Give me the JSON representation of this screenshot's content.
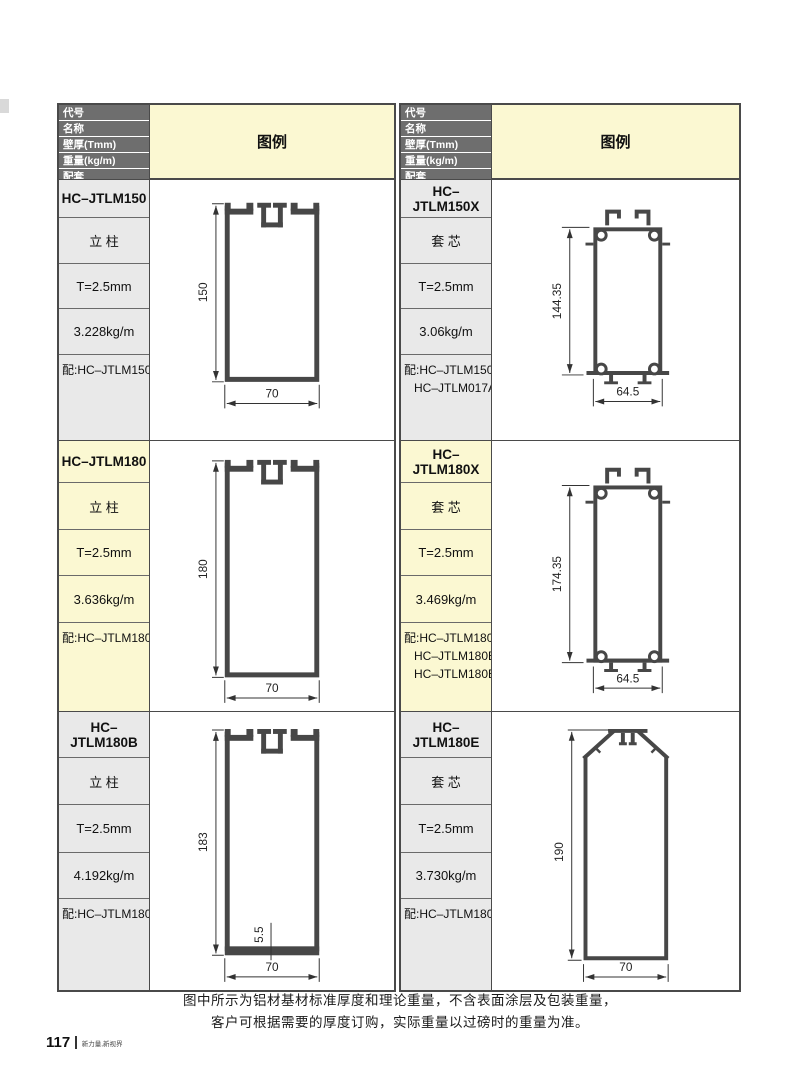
{
  "table_header": {
    "rows": [
      "代号",
      "名称",
      "壁厚(Tmm)",
      "重量(kg/m)",
      "配套"
    ],
    "legend": "图例"
  },
  "profiles": [
    {
      "code": "HC–JTLM150",
      "name": "立 柱",
      "thickness": "T=2.5mm",
      "weight": "3.228kg/m",
      "match_text": "配:HC–JTLM150X",
      "height_dim": "150",
      "width_dim": "70"
    },
    {
      "code": "HC–JTLM150X",
      "name": "套 芯",
      "thickness": "T=2.5mm",
      "weight": "3.06kg/m",
      "match_text": "配:HC–JTLM150\n   HC–JTLM017A",
      "height_dim": "144.35",
      "width_dim": "64.5"
    },
    {
      "code": "HC–JTLM180",
      "name": "立 柱",
      "thickness": "T=2.5mm",
      "weight": "3.636kg/m",
      "match_text": "配:HC–JTLM180X",
      "height_dim": "180",
      "width_dim": "70"
    },
    {
      "code": "HC–JTLM180X",
      "name": "套 芯",
      "thickness": "T=2.5mm",
      "weight": "3.469kg/m",
      "match_text": "配:HC–JTLM180\n   HC–JTLM180B\n   HC–JTLM180E",
      "height_dim": "174.35",
      "width_dim": "64.5"
    },
    {
      "code": "HC–JTLM180B",
      "name": "立 柱",
      "thickness": "T=2.5mm",
      "weight": "4.192kg/m",
      "match_text": "配:HC–JTLM180X",
      "height_dim": "183",
      "width_dim": "70",
      "bottom_bar_dim": "5.5"
    },
    {
      "code": "HC–JTLM180E",
      "name": "套 芯",
      "thickness": "T=2.5mm",
      "weight": "3.730kg/m",
      "match_text": "配:HC–JTLM180X",
      "height_dim": "190",
      "width_dim": "70"
    }
  ],
  "footer": {
    "note_line1": "图中所示为铝材基材标准厚度和理论重量，不含表面涂层及包装重量，",
    "note_line2": "客户可根据需要的厚度订购，实际重量以过磅时的重量为准。",
    "page_number": "117",
    "tagline": "新力量,新视界"
  },
  "colors": {
    "header_bg": "#6e6e6e",
    "header_text": "#ffffff",
    "legend_bg": "#fbf8d2",
    "gray_cell_bg": "#e9e9e9",
    "yellow_cell_bg": "#fbf8d2",
    "profile_line": "#474747",
    "table_border": "#4a4a4a"
  }
}
